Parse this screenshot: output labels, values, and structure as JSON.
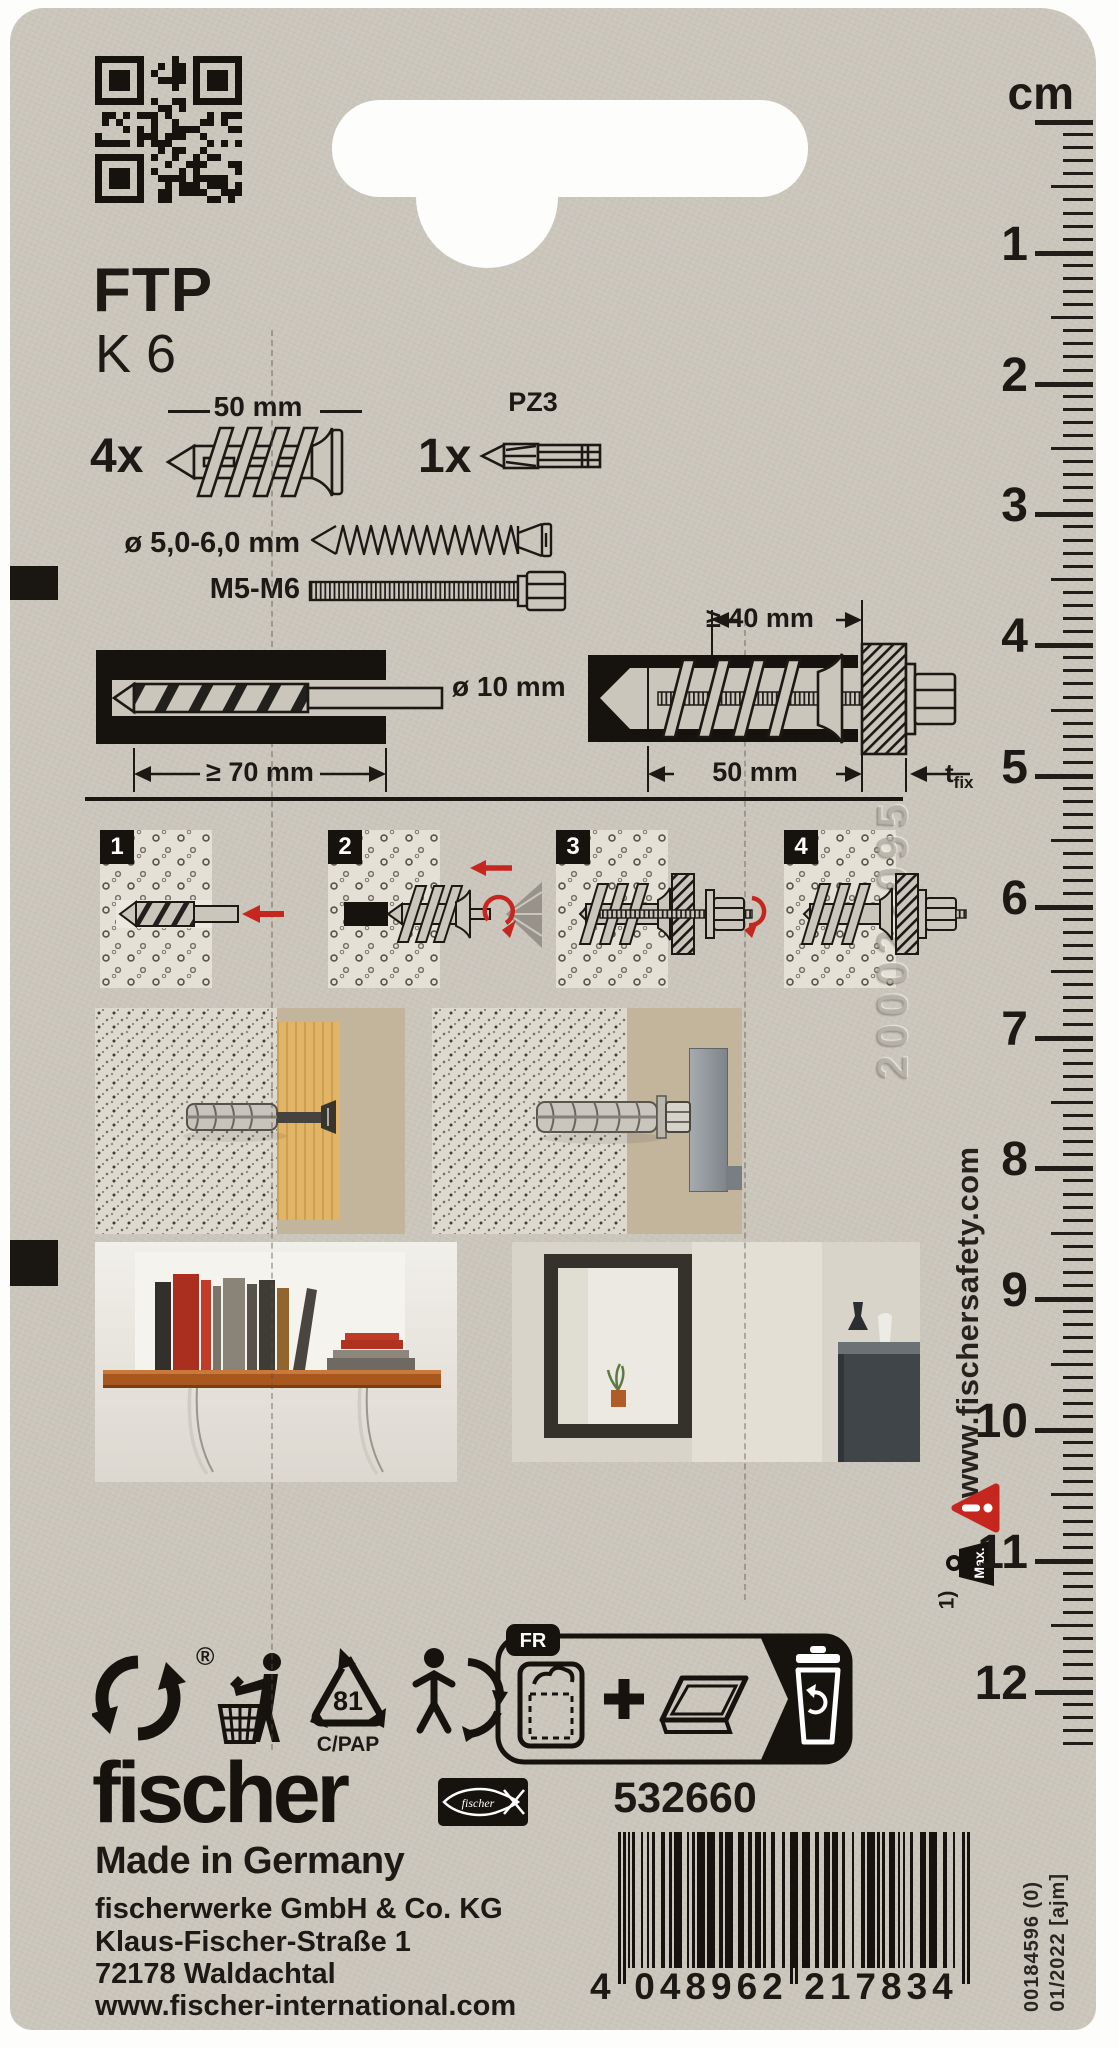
{
  "product": {
    "model": "FTP",
    "size": "K 6"
  },
  "contents": {
    "anchor_qty": "4x",
    "anchor_length": "50 mm",
    "bit_qty": "1x",
    "bit_label": "PZ3",
    "screw_range": "ø 5,0-6,0 mm",
    "metric_range": "M5-M6"
  },
  "install": {
    "drill_diameter": "ø 10 mm",
    "drill_depth": "≥ 70 mm",
    "min_substrate": "≥ 40 mm",
    "anchor_length": "50 mm",
    "fixture_base": "t",
    "fixture_sub": "fix"
  },
  "steps": [
    {
      "num": "1"
    },
    {
      "num": "2"
    },
    {
      "num": "3"
    },
    {
      "num": "4"
    }
  ],
  "ruler": {
    "unit": "cm",
    "numbers": [
      1,
      2,
      3,
      4,
      5,
      6,
      7,
      8,
      9,
      10,
      11,
      12
    ]
  },
  "side": {
    "website": "www.fischersafety.com",
    "footnote_ref": "1)",
    "max_label": "Max.",
    "embossed_code": "200022095"
  },
  "recycling": {
    "registered": "®",
    "resin_code": "81",
    "material_code": "C/PAP",
    "lang_tab": "FR"
  },
  "footer": {
    "brand": "fischer",
    "fish_wordmark": "fischer",
    "made_in": "Made in Germany",
    "company": "fischerwerke GmbH & Co. KG",
    "street": "Klaus-Fischer-Straße 1",
    "city": "72178 Waldachtal",
    "website": "www.fischer-international.com",
    "article": "532660",
    "ean_first": "4",
    "ean_group1": "048962",
    "ean_group2": "217834",
    "print_ref": "00184596 (0)",
    "print_date": "01/2022 [ajm]"
  },
  "colors": {
    "accent_red": "#c5271f",
    "print_black": "#1d1a16",
    "card": "#cbc6bc"
  }
}
